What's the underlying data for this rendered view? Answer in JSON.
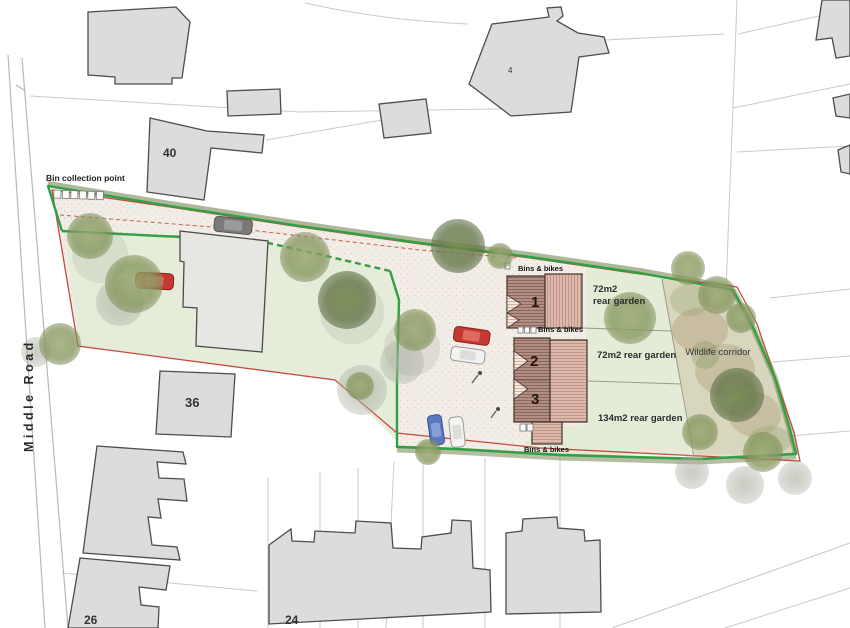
{
  "drawing": {
    "title": "Site plan",
    "labels": {
      "bin_collection_point": "Bin collection point",
      "middle_road": "Middle Road",
      "house_40": "40",
      "house_4": "4",
      "house_36": "36",
      "house_26": "26",
      "house_24": "24",
      "plot_1": "1",
      "plot_2": "2",
      "plot_3": "3",
      "bins_bikes": "Bins & bikes",
      "garden_72_l1": "72m2",
      "garden_72_l2": "rear garden",
      "garden_72": "72m2 rear garden",
      "garden_134": "134m2 rear garden",
      "wildlife_corridor": "Wildlife corridor"
    },
    "colors": {
      "boundary_green": "#2fa043",
      "boundary_red": "#c0392b",
      "hedge_green": "#5c7233",
      "roof_dark": "#b18e83",
      "roof_light": "#dcb9ab",
      "context_building": "#dcdcdc",
      "garden_green": "#e4ecd8",
      "site_surface": "#f2ede6",
      "tree_green": "#87985f"
    }
  }
}
